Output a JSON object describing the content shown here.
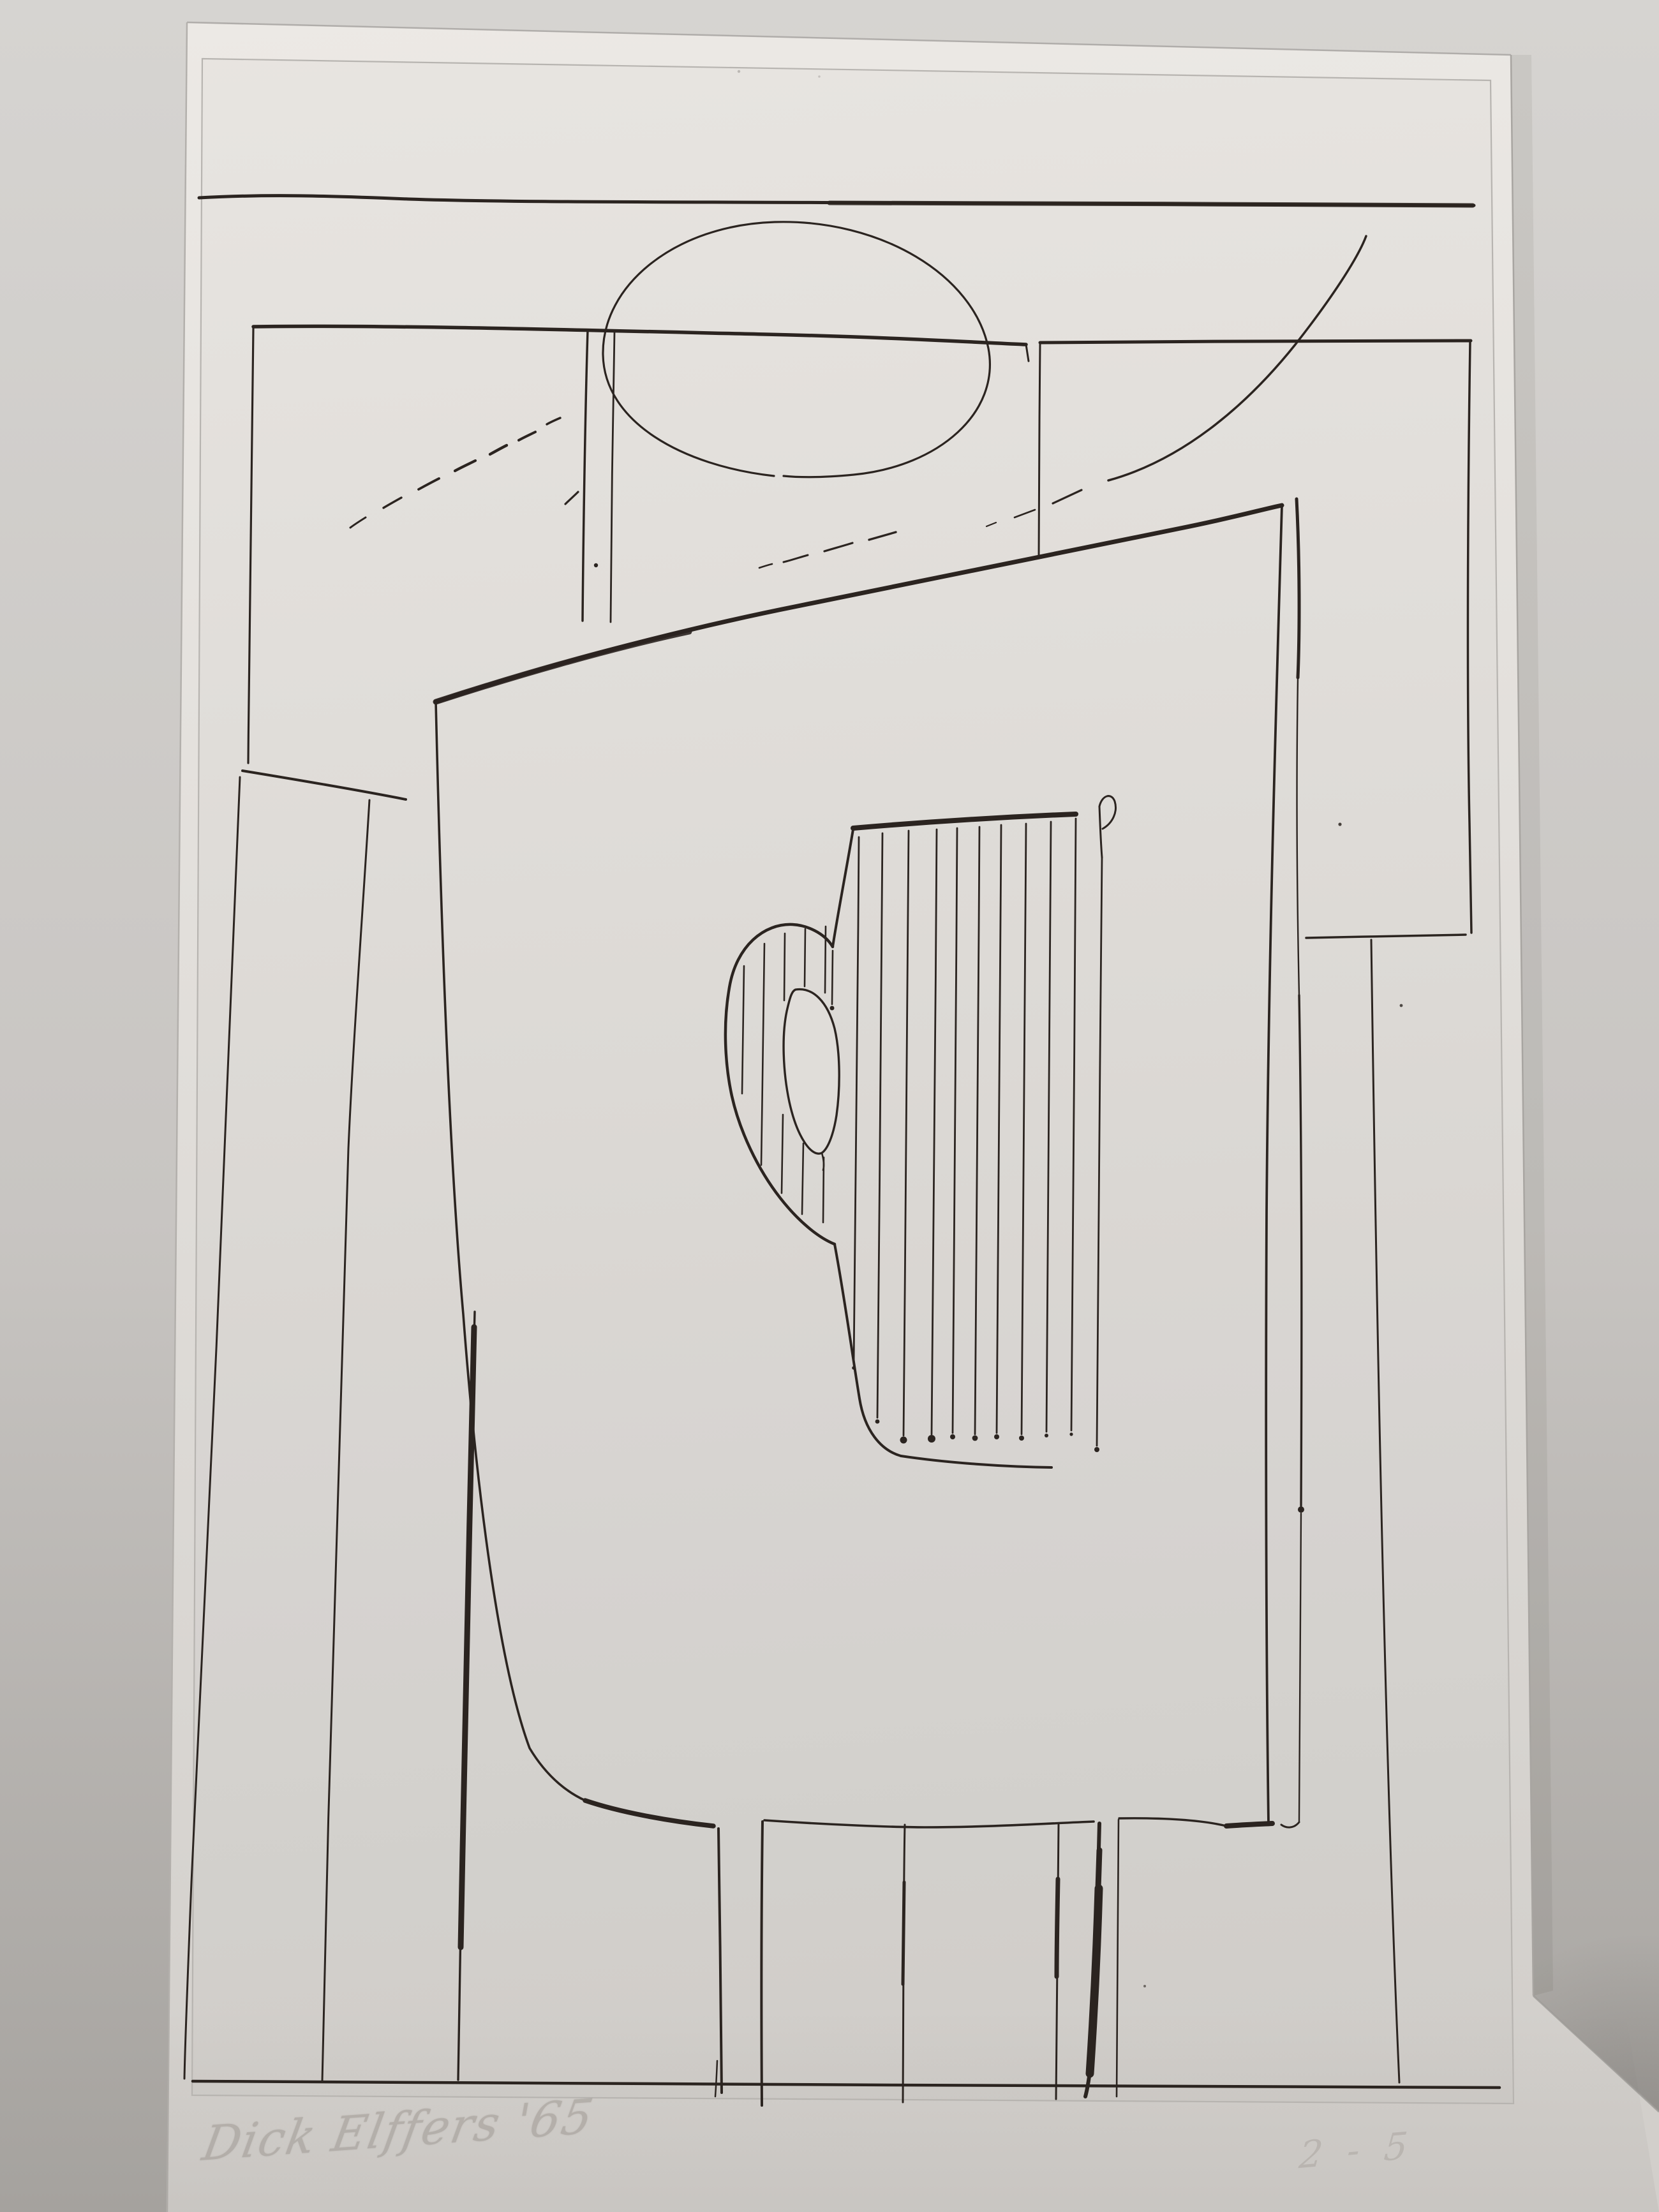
{
  "artwork": {
    "signature": "Dick Elffers '65",
    "edition": "2 - 5"
  },
  "colors": {
    "background": "#c8c5c2",
    "background_light": "#d6d4d1",
    "background_dark": "#a5a29e",
    "paper_light": "#ece9e5",
    "paper_mid": "#e0ddd9",
    "paper_dark": "#d2cfcb",
    "plate_line": "#b7b4b0",
    "ink": "#2b2420",
    "pencil": "#9d9791"
  }
}
